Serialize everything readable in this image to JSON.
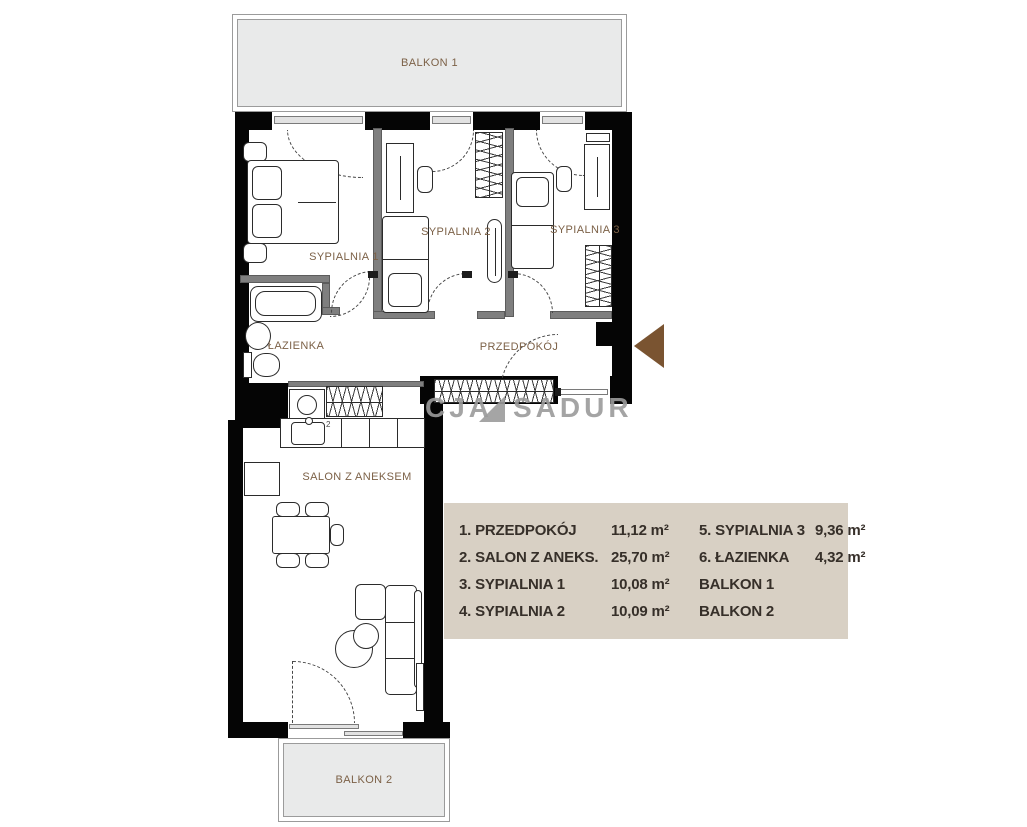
{
  "colors": {
    "wall": "#050505",
    "partition": "#7f7f7f",
    "room_label": "#7c6147",
    "balcony_fill": "#e9eaea",
    "legend_background": "#d8d0c4",
    "legend_text": "#362f29",
    "entrance_arrow": "#7a5431",
    "watermark_gray": "#9b9b9b"
  },
  "rooms": {
    "balkon1": "BALKON 1",
    "sypialnia1": "SYPIALNIA 1",
    "sypialnia2": "SYPIALNIA 2",
    "sypialnia3": "SYPIALNIA 3",
    "lazienka": "ŁAZIENKA",
    "przedpokoj": "PRZEDPOKÓJ",
    "salon": "SALON Z ANEKSEM",
    "balkon2": "BALKON 2"
  },
  "plan_markers": {
    "kitchen_number": "2"
  },
  "watermark": {
    "fragment1": "CJA",
    "fragment2": "SADUR"
  },
  "legend": {
    "items": [
      {
        "label": "1. PRZEDPOKÓJ",
        "value": "11,12 m²"
      },
      {
        "label": "2. SALON Z ANEKS.",
        "value": "25,70 m²"
      },
      {
        "label": "3. SYPIALNIA 1",
        "value": "10,08 m²"
      },
      {
        "label": "4. SYPIALNIA 2",
        "value": "10,09 m²"
      },
      {
        "label": "5. SYPIALNIA 3",
        "value": "9,36 m²"
      },
      {
        "label": "6. ŁAZIENKA",
        "value": "4,32 m²"
      },
      {
        "label": "BALKON 1",
        "value": ""
      },
      {
        "label": "BALKON 2",
        "value": ""
      }
    ]
  }
}
